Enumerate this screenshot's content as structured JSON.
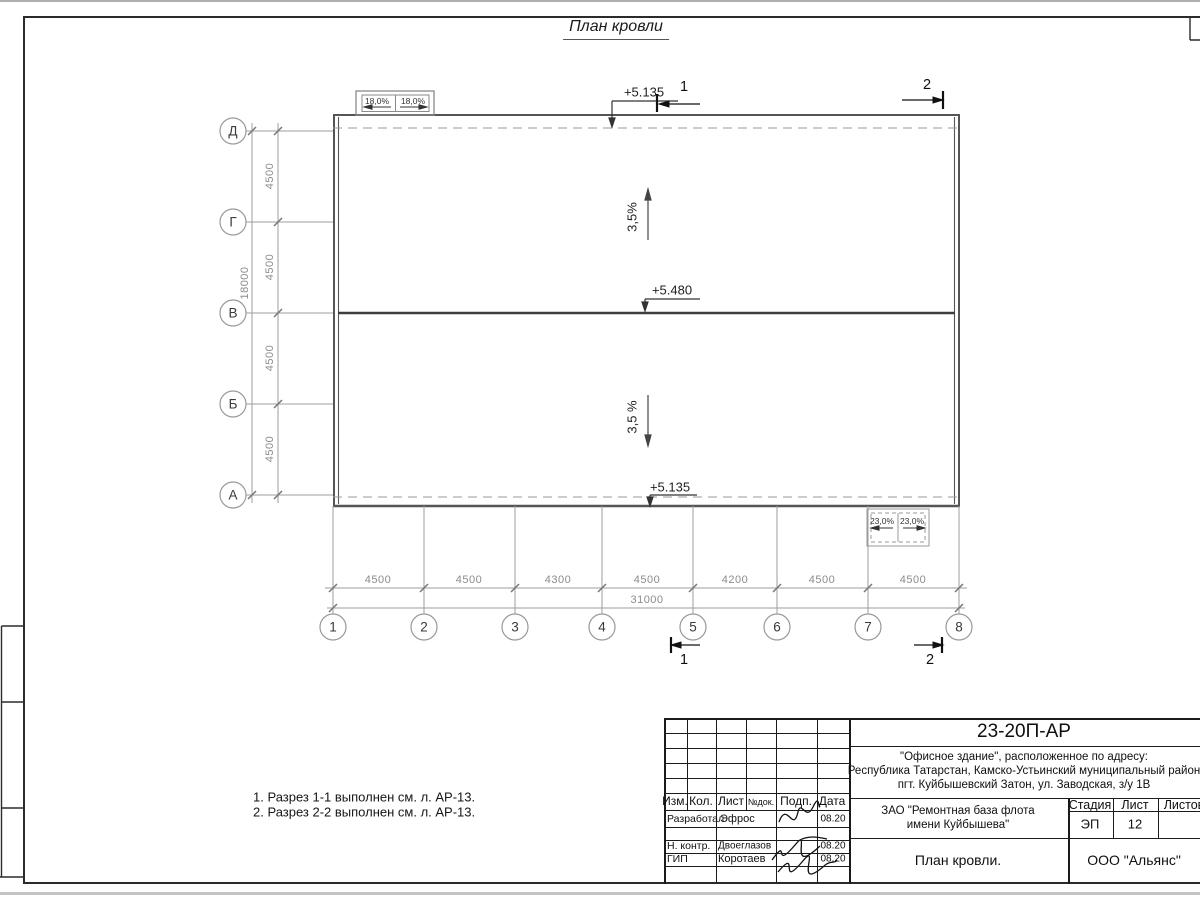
{
  "sheet": {
    "title": "План кровли"
  },
  "axes": {
    "cols": [
      "1",
      "2",
      "3",
      "4",
      "5",
      "6",
      "7",
      "8"
    ],
    "rows": [
      "Д",
      "Г",
      "В",
      "Б",
      "А"
    ]
  },
  "dims": {
    "bottom": [
      "4500",
      "4500",
      "4300",
      "4500",
      "4200",
      "4500",
      "4500"
    ],
    "bottom_total": "31000",
    "left": [
      "4500",
      "4500",
      "4500",
      "4500"
    ],
    "left_total": "18000"
  },
  "marks": {
    "elev_top": "+5.135",
    "elev_ridge": "+5.480",
    "elev_bottom": "+5.135",
    "slope_upper": "3,5%",
    "slope_lower": "3,5 %",
    "canopy_top_left": "18,0%",
    "canopy_top_right": "18,0%",
    "canopy_bottom_left": "23,0%",
    "canopy_bottom_right": "23,0%",
    "section_top_1": "1",
    "section_top_2": "2",
    "section_bottom_1": "1",
    "section_bottom_2": "2"
  },
  "notes": [
    "1. Разрез 1-1 выполнен см. л. АР-13.",
    "2. Разрез 2-2 выполнен см. л. АР-13."
  ],
  "titleblock": {
    "doc_number": "23-20П-АР",
    "address": [
      "\"Офисное здание\", расположенное по адресу:",
      "Республика Татарстан, Камско-Устьинский муниципальный район",
      "пгт. Куйбышевский Затон, ул. Заводская, з/у 1В"
    ],
    "columns": [
      "Изм.",
      "Кол.",
      "Лист",
      "№док.",
      "Подп.",
      "Дата"
    ],
    "signatures": [
      {
        "role": "Разработал",
        "name": "Эфрос",
        "date": "08.20"
      },
      {
        "role": "Н. контр.",
        "name": "Двоеглазов",
        "date": "08.20"
      },
      {
        "role": "ГИП",
        "name": "Коротаев",
        "date": "08.20"
      }
    ],
    "client_line1": "ЗАО \"Ремонтная база флота",
    "client_line2": "имени Куйбышева\"",
    "stage_label": "Стадия",
    "sheet_label": "Лист",
    "sheets_label": "Листов",
    "stage_value": "ЭП",
    "sheet_value": "12",
    "drawing_name": "План кровли.",
    "org": "ООО \"Альянс\""
  }
}
